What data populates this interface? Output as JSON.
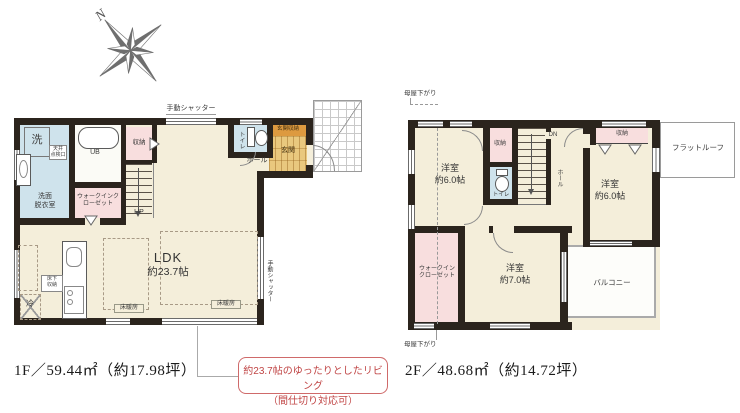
{
  "colors": {
    "wall": "#2b241d",
    "floor_cream": "#f4eeda",
    "closet_pink": "#f8dede",
    "wet_area_blue": "#cfe3ec",
    "entrance_tan": "#e9c87e",
    "entrance_storage_orange": "#dd9a40",
    "accent_red": "#c04545",
    "line_gray": "#8a8a8a"
  },
  "compass": {
    "north_label": "N"
  },
  "floor1": {
    "area_text": "1F／59.44㎡（約17.98坪）",
    "labels": {
      "shutter_top": "手動シャッター",
      "shutter_right": "手動シャッター",
      "washer": "洗",
      "washroom_line1": "洗面",
      "washroom_line2": "脱衣室",
      "inspection_line1": "天井",
      "inspection_line2": "点検口",
      "unit_bath": "UB",
      "storage": "収納",
      "walk_in_closet": "ウォークインクローゼット",
      "stairs_up": "UP",
      "toilet": "トイレ",
      "hall": "ホール",
      "entrance_storage": "玄関収納",
      "entrance": "玄関",
      "ldk_name": "LDK",
      "ldk_size": "約23.7帖",
      "underfloor_line1": "床下",
      "underfloor_line2": "収納",
      "fridge": "冷",
      "floor_heating_left": "床暖房",
      "floor_heating_right": "床暖房"
    }
  },
  "floor2": {
    "area_text": "2F／48.68㎡（約14.72坪）",
    "labels": {
      "moya_sagari_top": "母屋下がり",
      "moya_sagari_bottom": "母屋下がり",
      "room_nw_name": "洋室",
      "room_nw_size": "約6.0帖",
      "room_ne_name": "洋室",
      "room_ne_size": "約6.0帖",
      "room_s_name": "洋室",
      "room_s_size": "約7.0帖",
      "storage_center": "収納",
      "storage_ne": "収納",
      "toilet": "トイレ",
      "stairs_down": "DN",
      "hall": "ホール",
      "walk_in_closet": "ウォークインクローゼット",
      "flat_roof": "フラットルーフ",
      "balcony": "バルコニー"
    }
  },
  "callout": {
    "line1": "約23.7帖のゆったりとしたリビング",
    "line2": "（間仕切り対応可）"
  }
}
